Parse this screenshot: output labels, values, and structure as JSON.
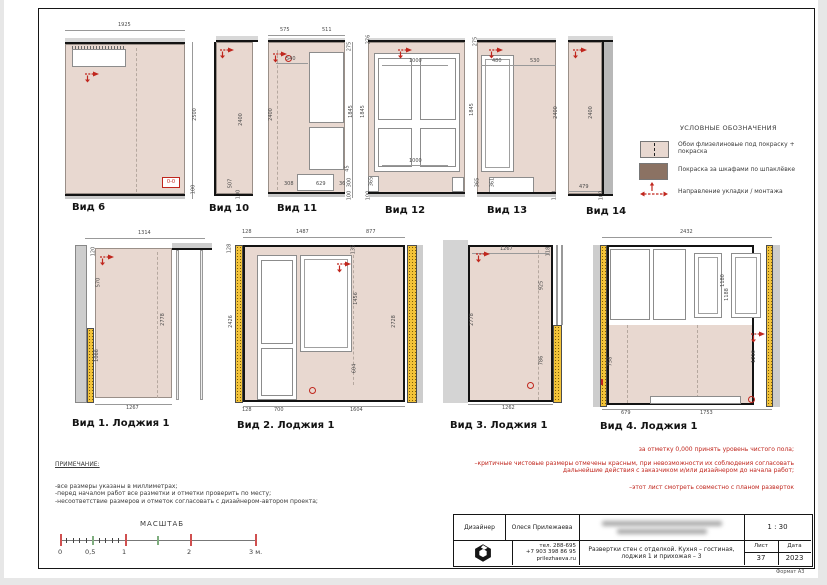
{
  "views": {
    "v6": {
      "label": "Вид 6",
      "top": "1925",
      "right": "2500",
      "b100": "100",
      "badge": "0-0"
    },
    "v10": {
      "label": "Вид 10",
      "h": "2400",
      "b507": "507",
      "b100": "100"
    },
    "v11": {
      "label": "Вид 11",
      "t575": "575",
      "t511": "511",
      "i540": "540",
      "l2400": "2400",
      "r275": "275",
      "r1845": "1845",
      "r45": "45",
      "r300": "300",
      "r100": "100",
      "b308": "308",
      "b629": "629",
      "b36": "36"
    },
    "v12": {
      "label": "Вид 12",
      "tl276": "276",
      "t1000": "1000",
      "l1845": "1845",
      "b1000": "1000",
      "l365": "365",
      "b100": "100"
    },
    "v13": {
      "label": "Вид 13",
      "tl275": "275",
      "t480": "480",
      "t530": "530",
      "l1845": "1845",
      "r2400": "2400",
      "i365": "365",
      "i361": "361",
      "b100": "100"
    },
    "v14": {
      "label": "Вид 14",
      "h": "2400",
      "b479": "479",
      "b100": "100"
    },
    "l1": {
      "label": "Вид 1. Лоджия 1",
      "t1314": "1314",
      "tl120": "120",
      "i570": "570",
      "i1066": "1066",
      "r2778": "2778",
      "b1267": "1267"
    },
    "l2": {
      "label": "Вид 2.  Лоджия 1",
      "t128": "128",
      "t1487": "1487",
      "t877": "877",
      "lt128": "128",
      "l2426": "2426",
      "i135": "135",
      "i1456": "1456",
      "i604": "604",
      "r2728": "2728",
      "b128": "128",
      "b700": "700",
      "b1604": "1604"
    },
    "l3": {
      "label": "Вид 3. Лоджия 1",
      "t1267": "1267",
      "t118": "118",
      "l2778": "2778",
      "i925": "925",
      "i786": "786",
      "b1262": "1262"
    },
    "l4": {
      "label": "Вид 4.  Лоджия 1",
      "t2432": "2432",
      "i1180": "1180",
      "i1188": "1188",
      "l758": "758",
      "r1216": "1216",
      "b679": "679",
      "b1753": "1753"
    }
  },
  "legend": {
    "title": "УСЛОВНЫЕ ОБОЗНАЧЕНИЯ",
    "items": [
      {
        "label": "Обои флизелиновые под покраску + покраска",
        "swatch": "#e8d8d0"
      },
      {
        "label": "Покраска за шкафами по шпаклёвке",
        "swatch": "#8b7263"
      },
      {
        "label": "Направление укладки / монтажа",
        "swatch": "red-arrows"
      }
    ]
  },
  "red_notes": {
    "l1": "за отметку 0,000 принять уровень чистого пола;",
    "l2": "–критичные чистовые размеры отмечены красным, при невозможности их соблюдения согласовать дальнейшие действия с заказчиком и/или дизайнером до начала работ;",
    "l3": "–этот лист смотреть совместно с планом разверток"
  },
  "notes": {
    "title": "ПРИМЕЧАНИЕ:",
    "l1": "-все размеры указаны в миллиметрах;",
    "l2": "-перед началом работ все разметки и отметки проверить по месту;",
    "l3": "-несоответствие размеров и отметок согласовать с дизайнером-автором проекта;"
  },
  "scale": {
    "title": "МАСШТАБ",
    "t0": "0",
    "t05": "0,5",
    "t1": "1",
    "t2": "2",
    "t3": "3 м."
  },
  "titleblock": {
    "designer_label": "Дизайнер",
    "designer_name": "Олеся Прилежаева",
    "scale_value": "1 : 30",
    "phone1": "тел. 288-695",
    "phone2": "+7 903 398 86 95",
    "site": "prilezhaeva.ru",
    "doc_title": "Развертки стен с отделкой. Кухня – гостиная, лоджия 1 и прихожая – 3",
    "sheet_label": "Лист",
    "sheet_value": "37",
    "date_label": "Дата",
    "date_value": "2023",
    "format": "Формат А3"
  },
  "colors": {
    "wall": "#e8d8d0",
    "cabinet_paint": "#8b7263",
    "insulation": "#f3c339",
    "accent_red": "#c0261d"
  }
}
